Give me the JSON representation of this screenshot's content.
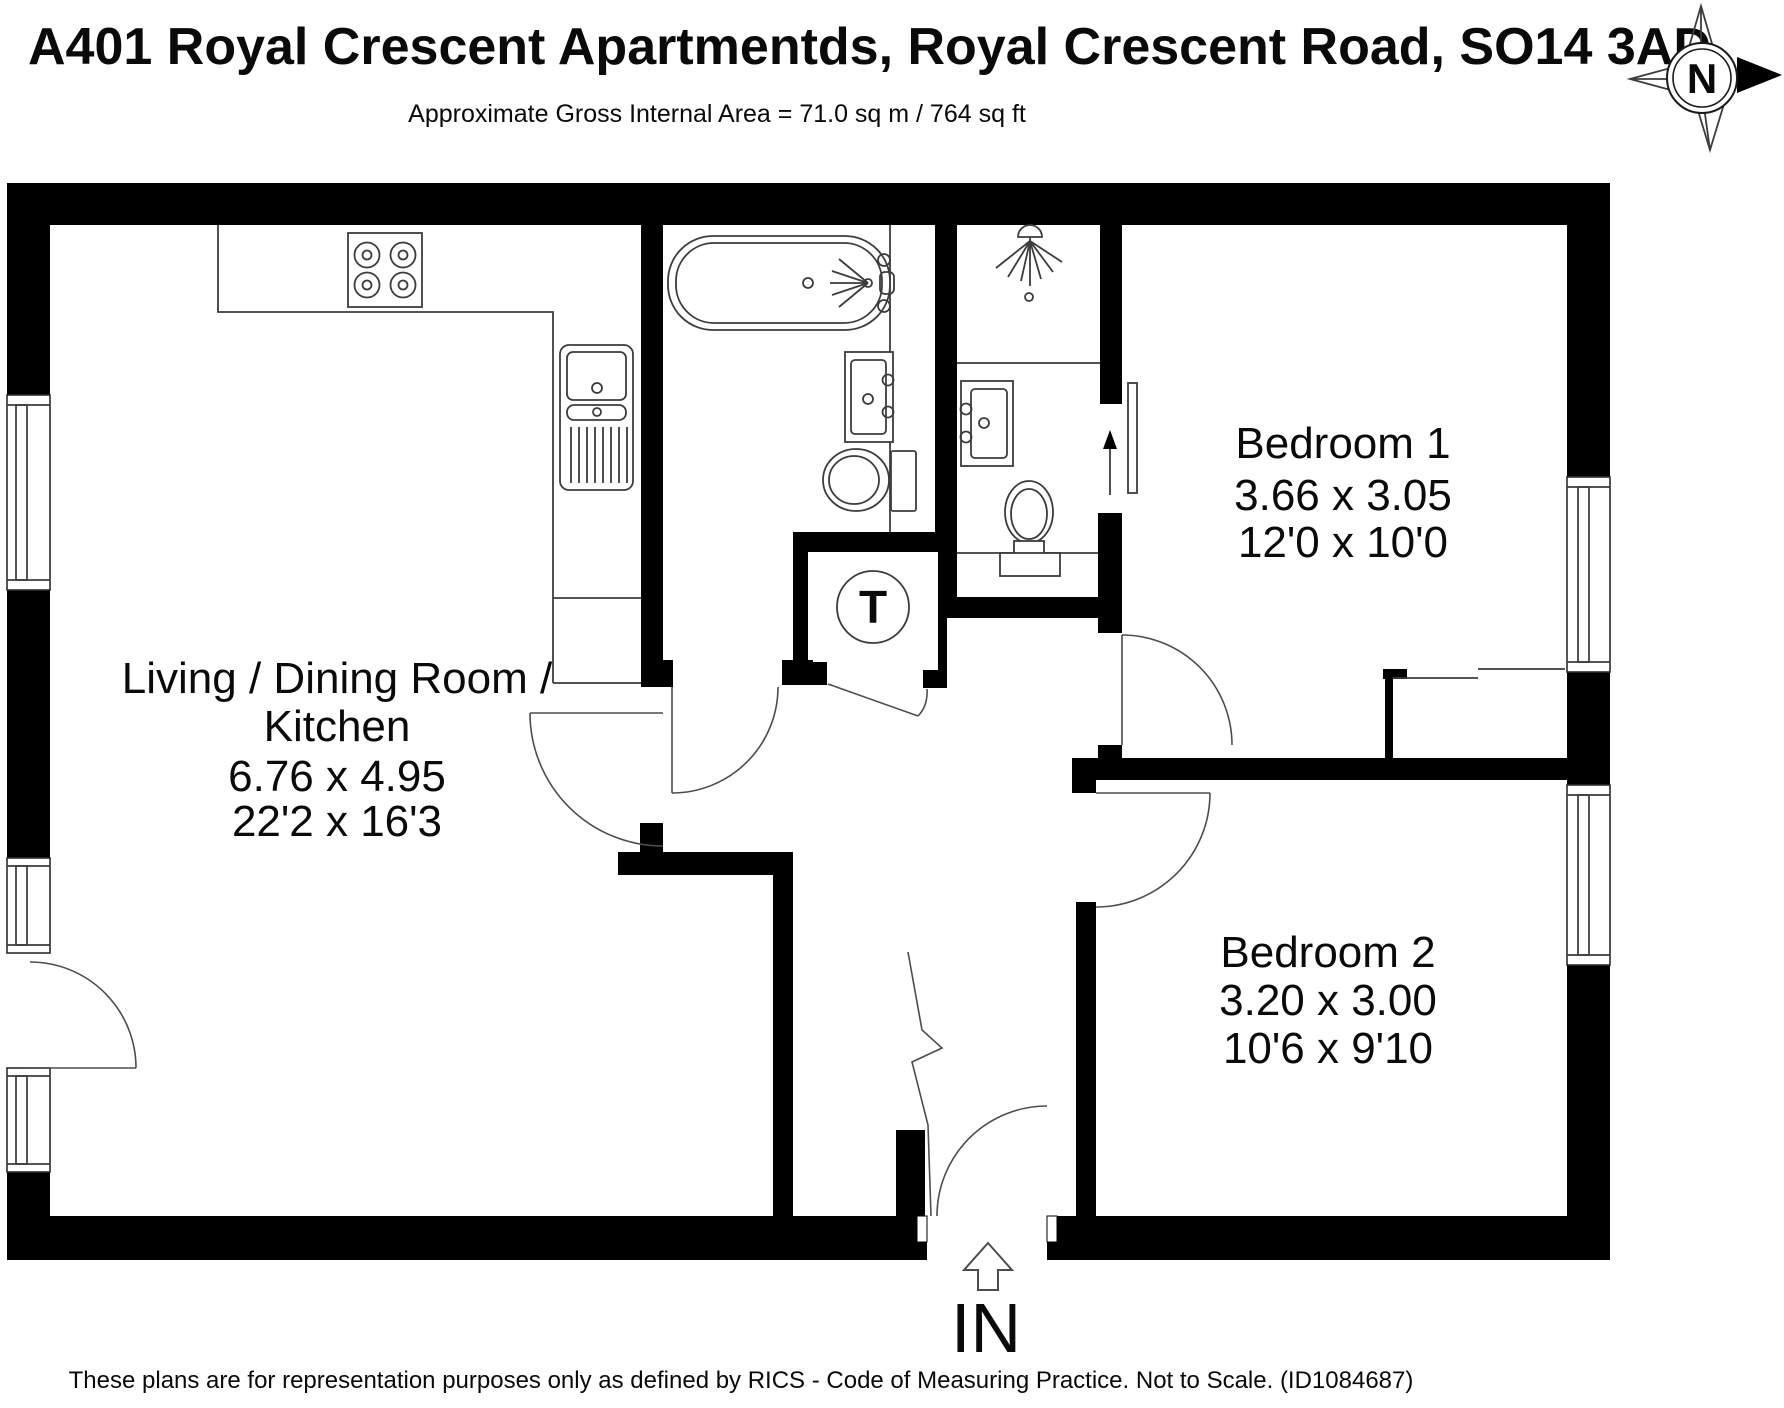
{
  "header": {
    "title": "A401 Royal Crescent Apartmentds, Royal Crescent Road, SO14 3AD",
    "subtitle": "Approximate Gross Internal Area = 71.0 sq m / 764 sq ft"
  },
  "compass": {
    "north_label": "N"
  },
  "rooms": {
    "living": {
      "name_line1": "Living / Dining Room /",
      "name_line2": "Kitchen",
      "dims_metric": "6.76 x 4.95",
      "dims_imperial": "22'2 x 16'3"
    },
    "bedroom1": {
      "name": "Bedroom 1",
      "dims_metric": "3.66 x 3.05",
      "dims_imperial": "12'0 x 10'0"
    },
    "bedroom2": {
      "name": "Bedroom 2",
      "dims_metric": "3.20 x 3.00",
      "dims_imperial": "10'6 x 9'10"
    }
  },
  "labels": {
    "entrance": "IN",
    "water_tank": "T"
  },
  "fixtures": [
    "hob-icon",
    "kitchen-sink-icon",
    "bath-icon",
    "bathroom-basin-icon",
    "bathroom-toilet-icon",
    "shower-icon",
    "shower-room-basin-icon",
    "shower-room-toilet-icon",
    "water-tank-icon",
    "wardrobe-icon"
  ],
  "footer": {
    "disclaimer": "These plans are for representation purposes only as defined by RICS - Code of Measuring Practice. Not to Scale. (ID1084687)"
  },
  "colors": {
    "wall": "#000000",
    "line": "#3c3c3c",
    "background": "#ffffff"
  }
}
